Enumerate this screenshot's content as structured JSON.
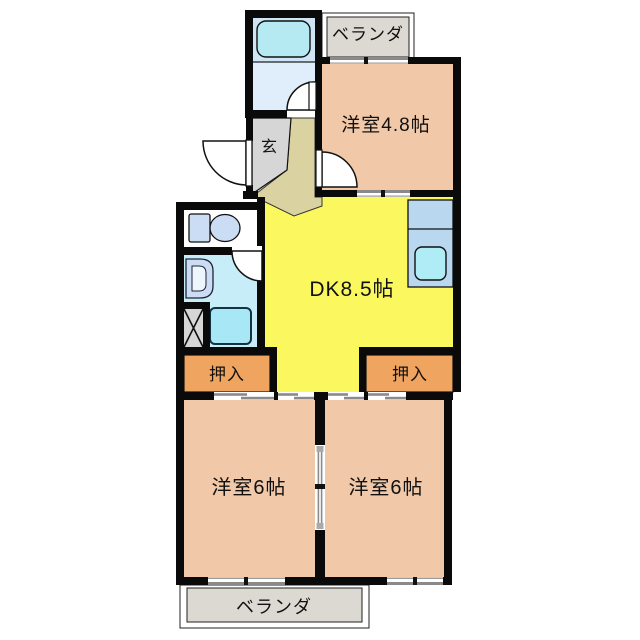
{
  "plan": {
    "type": "apartment-floor-plan",
    "labels": {
      "balcony_top": "ベランダ",
      "room_48": "洋室4.8帖",
      "entrance": "玄",
      "dk": "DK8.5帖",
      "closet_left": "押入",
      "closet_right": "押入",
      "bedroom_left": "洋室6帖",
      "bedroom_right": "洋室6帖",
      "balcony_bottom": "ベランダ"
    },
    "fixtures": [
      "bathtub",
      "toilet",
      "washbasin",
      "washing-machine",
      "kitchen-sink",
      "storage-x"
    ],
    "colors": {
      "wall": "#0a0a0a",
      "room_peach": "#f1c9a8",
      "dk_yellow": "#fbf75f",
      "closet_orange": "#efa45f",
      "balcony_gray": "#dcd8d2",
      "entrance_gray": "#d6d6d6",
      "hall_beige": "#dbd2a2",
      "bath_upper": "#cfe5f5",
      "bathtub_cyan": "#b5eaf3",
      "bath_lower": "#dfeefa",
      "toilet_floor": "#ffffff",
      "fixture_blue": "#cbdcf5",
      "sanitary_cyan": "#c6edf8",
      "washer_cyan": "#a8e7f6",
      "counter_blue": "#b9d8f0",
      "sink_cyan": "#b0ecf5",
      "storage_gray": "#d6d6d6",
      "mark_gray": "#8a8a8a"
    }
  }
}
